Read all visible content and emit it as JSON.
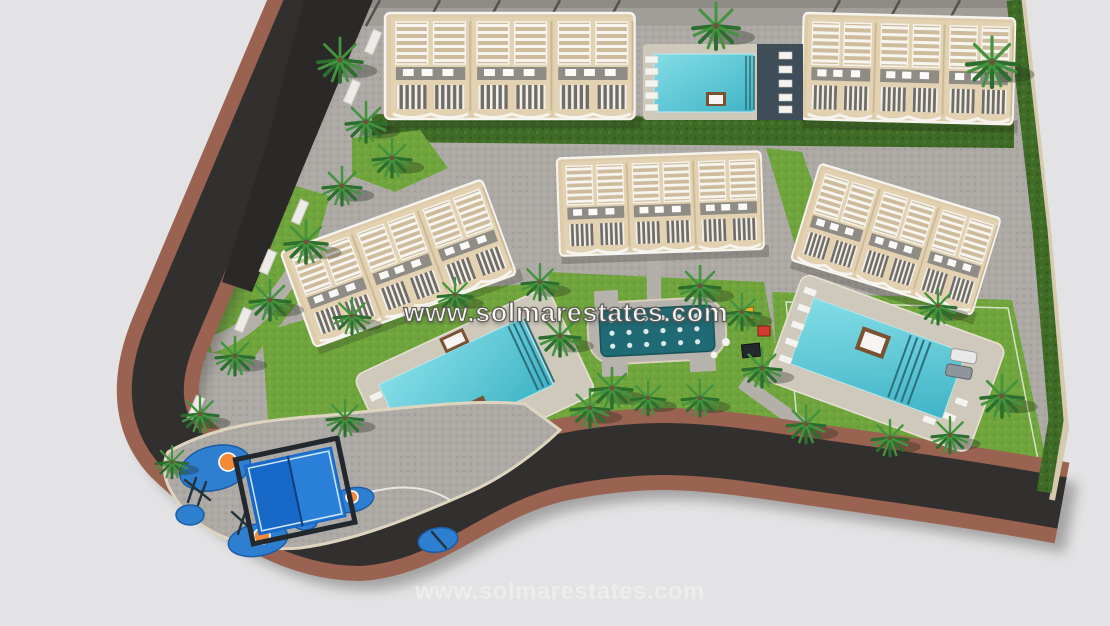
{
  "page": {
    "title": "Residential development aerial site plan - 3D render"
  },
  "watermark": {
    "primary": "www.solmarestates.com",
    "secondary": "www.solmarestates.com"
  },
  "scene": {
    "description": "Bird's-eye 3D architectural render of a triangular residential plot: five cream apartment blocks with white roof pergolas, three turquoise swimming pools with sun loungers and daybeds, a central teal splash pad with seats, a children's playground with blue play zones, a blue padel court, lawns, palm trees and a curving perimeter road with terracotta sidewalk bands.",
    "buildings": [
      "top-left apartment block",
      "top-right apartment block",
      "west apartment block",
      "central apartment block",
      "east apartment block"
    ],
    "amenities": [
      "top swimming pool",
      "west swimming pool",
      "east swimming pool",
      "splash pad",
      "children's playground",
      "padel court"
    ],
    "colors": {
      "background": "#e3e2e4",
      "road_asphalt": "#32302e",
      "sidewalk_terracotta": "#9a6250",
      "curb_beige": "#ded5c0",
      "pavement": "#adaaa5",
      "lawn": "#6fa53c",
      "hedge": "#3f6b26",
      "palm": "#2c6e2e",
      "building_cream": "#e3d2b2",
      "pergola_white": "#f6f4ef",
      "pool_water": "#5ecbdb",
      "pool_deck": "#cfc9bc",
      "dark_deck": "#3f4d59",
      "splash_pad_teal": "#1f6a74",
      "play_blue": "#2e7fd0",
      "play_orange": "#f28a3a",
      "padel_blue": "#1868c8",
      "daybed_brown": "#7a5232"
    }
  }
}
